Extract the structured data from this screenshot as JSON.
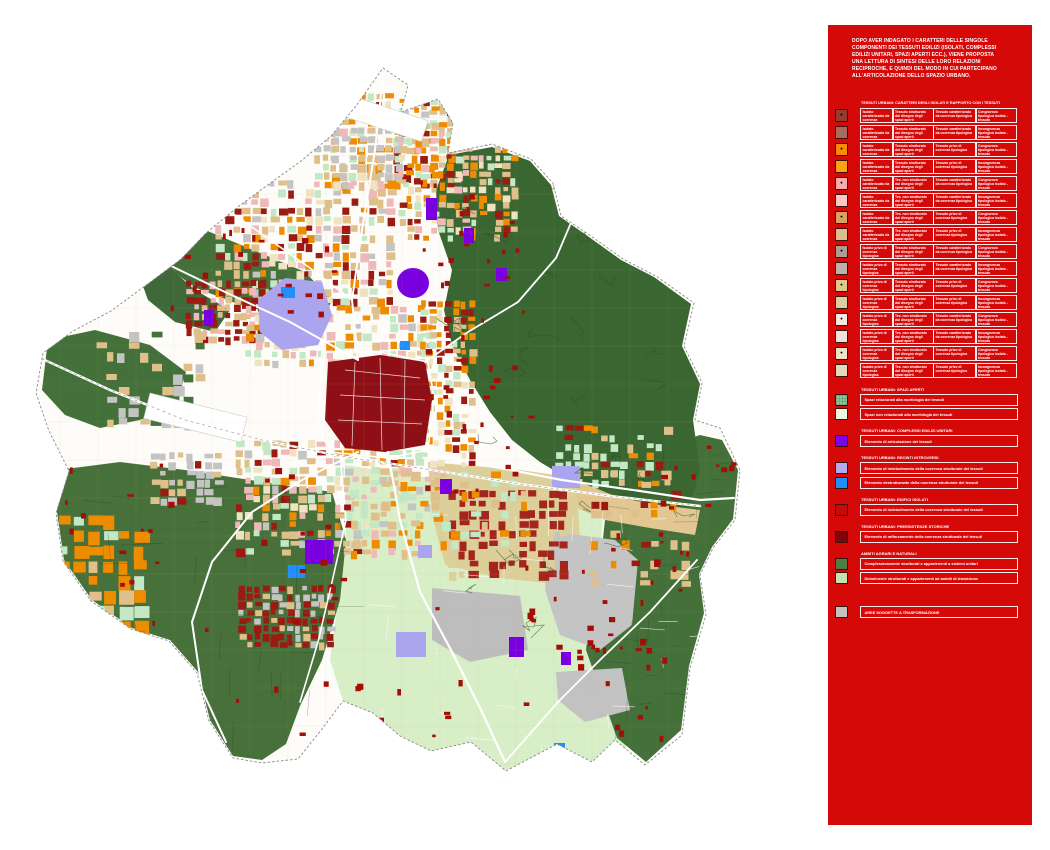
{
  "panel": {
    "background": "#D60909",
    "intro": "DOPO AVER INDAGATO I CARATTERI DELLE SINGOLE COMPONENTI DEI TESSUTI EDILIZI (ISOLATI, COMPLESSI EDILIZI UNITARI, SPAZI APERTI ECC.), VIENE PROPOSTA UNA LETTURA DI SINTESI DELLE LORO RELAZIONI RECIPROCHE, E QUINDI DEL MODO IN CUI PARTECIPANO ALL'ARTICOLAZIONE DELLO SPAZIO URBANO.",
    "table": {
      "title": "TESSUTI URBANI: CARATTERI DEGLI ISOLATI E RAPPORTO CON I TESSUTI",
      "rows": [
        {
          "swatch": "#953B30",
          "dot": "●",
          "c1": "Isolato caratterizzato da coerenza tipologica",
          "c2": "Tessuto strutturato dal disegno degli spazi aperti",
          "c3": "Tessuto caratterizzato da coerenza tipologica",
          "c4": "Congruenza tipologica isolato - tessuto"
        },
        {
          "swatch": "#A86B60",
          "dot": "",
          "c1": "Isolato caratterizzato da coerenza tipologica",
          "c2": "Tessuto strutturato dal disegno degli spazi aperti",
          "c3": "Tessuto caratterizzato da coerenza tipologica",
          "c4": "Incongruenza tipologica isolato - tessuto"
        },
        {
          "swatch": "#FB8B02",
          "dot": "●",
          "c1": "Isolato caratterizzato da coerenza tipologica",
          "c2": "Tessuto strutturato dal disegno degli spazi aperti",
          "c3": "Tessuto privo di coerenza tipologica",
          "c4": "Congruenza tipologica isolato - tessuto"
        },
        {
          "swatch": "#FFA114",
          "dot": "",
          "c1": "Isolato caratterizzato da coerenza tipologica",
          "c2": "Tessuto strutturato dal disegno degli spazi aperti",
          "c3": "Tessuto privo di coerenza tipologica",
          "c4": "Incongruenza tipologica isolato - tessuto"
        },
        {
          "swatch": "#F8ACA9",
          "dot": "●",
          "c1": "Isolato caratterizzato da coerenza tipologica",
          "c2": "Tes. non strutturato dal disegno degli spazi aperti",
          "c3": "Tessuto caratterizzato da coerenza tipologica",
          "c4": "Congruenza tipologica isolato - tessuto"
        },
        {
          "swatch": "#FBC6C3",
          "dot": "",
          "c1": "Isolato caratterizzato da coerenza tipologica",
          "c2": "Tes. non strutturato dal disegno degli spazi aperti",
          "c3": "Tessuto caratterizzato da coerenza tipologica",
          "c4": "Incongruenza tipologica isolato - tessuto"
        },
        {
          "swatch": "#D8A263",
          "dot": "●",
          "c1": "Isolato caratterizzato da coerenza tipologica",
          "c2": "Tes. non strutturato dal disegno degli spazi aperti",
          "c3": "Tessuto privo di coerenza tipologica",
          "c4": "Congruenza tipologica isolato - tessuto"
        },
        {
          "swatch": "#DEBC8F",
          "dot": "",
          "c1": "Isolato caratterizzato da coerenza tipologica",
          "c2": "Tes. non strutturato dal disegno degli spazi aperti",
          "c3": "Tessuto privo di coerenza tipologica",
          "c4": "Incongruenza tipologica isolato - tessuto"
        },
        {
          "swatch": "#AE9B92",
          "dot": "●",
          "c1": "Isolato privo di coerenza tipologica",
          "c2": "Tessuto strutturato dal disegno degli spazi aperti",
          "c3": "Tessuto caratterizzato da coerenza tipologica",
          "c4": "Congruenza tipologica isolato - tessuto"
        },
        {
          "swatch": "#BFB1AA",
          "dot": "",
          "c1": "Isolato privo di coerenza tipologica",
          "c2": "Tessuto strutturato dal disegno degli spazi aperti",
          "c3": "Tessuto caratterizzato da coerenza tipologica",
          "c4": "Incongruenza tipologica isolato - tessuto"
        },
        {
          "swatch": "#E2C78C",
          "dot": "●",
          "c1": "Isolato privo di coerenza tipologica",
          "c2": "Tessuto strutturato dal disegno degli spazi aperti",
          "c3": "Tessuto privo di coerenza tipologica",
          "c4": "Congruenza tipologica isolato - tessuto"
        },
        {
          "swatch": "#DBCFA2",
          "dot": "",
          "c1": "Isolato privo di coerenza tipologica",
          "c2": "Tessuto strutturato dal disegno degli spazi aperti",
          "c3": "Tessuto privo di coerenza tipologica",
          "c4": "Incongruenza tipologica isolato - tessuto"
        },
        {
          "swatch": "#F4E8E3",
          "dot": "●",
          "c1": "Isolato privo di coerenza tipologica",
          "c2": "Tes. non strutturato dal disegno degli spazi aperti",
          "c3": "Tessuto caratterizzato da coerenza tipologica",
          "c4": "Congruenza tipologica isolato - tessuto"
        },
        {
          "swatch": "#EFE1DC",
          "dot": "",
          "c1": "Isolato privo di coerenza tipologica",
          "c2": "Tes. non strutturato dal disegno degli spazi aperti",
          "c3": "Tessuto caratterizzato da coerenza tipologica",
          "c4": "Incongruenza tipologica isolato - tessuto"
        },
        {
          "swatch": "#EFE3C4",
          "dot": "●",
          "c1": "Isolato privo di coerenza tipologica",
          "c2": "Tes. non strutturato dal disegno degli spazi aperti",
          "c3": "Tessuto privo di coerenza tipologica",
          "c4": "Congruenza tipologica isolato - tessuto"
        },
        {
          "swatch": "#E4DABB",
          "dot": "",
          "c1": "Isolato privo di coerenza tipologica",
          "c2": "Tes. non strutturato dal disegno degli spazi aperti",
          "c3": "Tessuto privo di coerenza tipologica",
          "c4": "Incongruenza tipologica isolato - tessuto"
        }
      ]
    },
    "sections": [
      {
        "title": "TESSUTI URBANI: SPAZI APERTI",
        "items": [
          {
            "swatch": "#8FC79B",
            "pattern": "grid",
            "label": "Spazi relazionati alla morfologia dei tessuti"
          },
          {
            "swatch": "#EAF5E3",
            "pattern": "",
            "label": "Spazi non relazionati alla morfologia dei tessuti"
          }
        ]
      },
      {
        "title": "TESSUTI URBANI: COMPLESSI EDILIZI UNITARI",
        "items": [
          {
            "swatch": "#7C04E8",
            "pattern": "",
            "label": "Elemento di articolazione dei tessuti"
          }
        ]
      },
      {
        "title": "TESSUTI URBANI: RECINTI INTROVERSI",
        "items": [
          {
            "swatch": "#B3ABF2",
            "pattern": "",
            "label": "Elemento di indebolimento della coerenza strutturale dei tessuti"
          },
          {
            "swatch": "#1F8FFB",
            "pattern": "",
            "label": "Elemento destrutturante della coerenza strutturale dei tessuti"
          }
        ]
      },
      {
        "title": "TESSUTI URBANI: EDIFICI ISOLATI",
        "items": [
          {
            "swatch": "#C60A0A",
            "pattern": "",
            "label": "Elemento di indebolimento della coerenza strutturale dei tessuti"
          }
        ]
      },
      {
        "title": "TESSUTI URBANI: PREESISTENZE STORICHE",
        "items": [
          {
            "swatch": "#7E0508",
            "pattern": "",
            "label": "Elemento di rafforzamento della coerenza strutturale dei tessuti"
          }
        ]
      },
      {
        "title": "AMBITI AGRARI E NATURALI",
        "items": [
          {
            "swatch": "#4E7D44",
            "pattern": "",
            "label": "Complessivamente strutturati e appartenenti a sistemi unitari"
          },
          {
            "swatch": "#C4E2AC",
            "pattern": "",
            "label": "Debolmente strutturati e appartenenti ad ambiti di transizione"
          }
        ]
      }
    ],
    "standalone_item": {
      "swatch": "#C2C2C2",
      "label": "AREE SOGGETTE A TRASFORMAZIONE"
    }
  }
}
